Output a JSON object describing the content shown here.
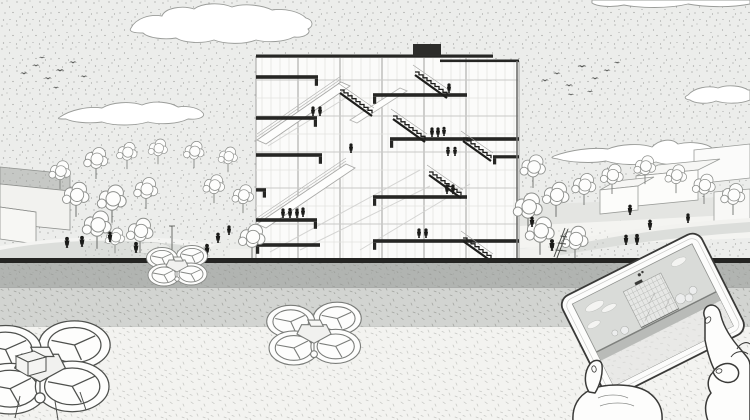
{
  "meta": {
    "description": "Monochrome stippled architectural illustration: cut-away sectional perspective of a multi-storey building above a plaza with trees and pedestrians, a dark-capped wall, three camera quadcopter drones, and two hands holding a tablet that displays a miniature view of the same building scene.",
    "style": "stippled black-and-white line drawing"
  },
  "palette": {
    "sky": "#ecedeb",
    "stipple": "#8f918f",
    "ink": "#262624",
    "outline": "#9a9a98",
    "wall_band": "#b1b4b1",
    "middle_band": "#d2d4d1",
    "foreground": "#f3f3f0",
    "screen": "#d9dbd8",
    "white": "#fdfdfc"
  },
  "scene": {
    "labels": {
      "illustration": "Architectural sectional perspective with drones and tablet",
      "sky": "Stippled sky",
      "clouds": "Outlined clouds",
      "birds": "Flocks of birds",
      "left_structure": "Low concrete structure",
      "houses": "Low gabled houses",
      "trees": "Line-drawn trees",
      "plaza": "Plaza with paths and pedestrians",
      "pedestrians": "Pedestrian figures",
      "building": "Sectional perspective of multi-storey building with stairs, ramps and occupants",
      "roof_unit": "Dark rooftop unit",
      "wall": "Dark-capped retaining wall",
      "middle_band": "Textured terrace band",
      "foreground": "Light foreground plane",
      "drone_large": "Large camera quadcopter, lower left",
      "drone_hover": "Quadcopter hovering at the wall",
      "drone_center": "Quadcopter over the foreground",
      "tablet": "Hand-held tablet showing the same scene",
      "tablet_screen": "Tablet screen with miniature building view",
      "left_hand": "Left hand holding the tablet",
      "right_hand": "Right hand touching the screen",
      "ladder_figure": "Figure with ladder",
      "lamp": "Lamp post"
    },
    "counts": {
      "clouds": 5,
      "birds": 17,
      "drones": 3,
      "hands": 2,
      "building_stair_runs": 6,
      "building_occupants": 15,
      "plaza_pedestrians": 14,
      "trees": 26
    }
  }
}
